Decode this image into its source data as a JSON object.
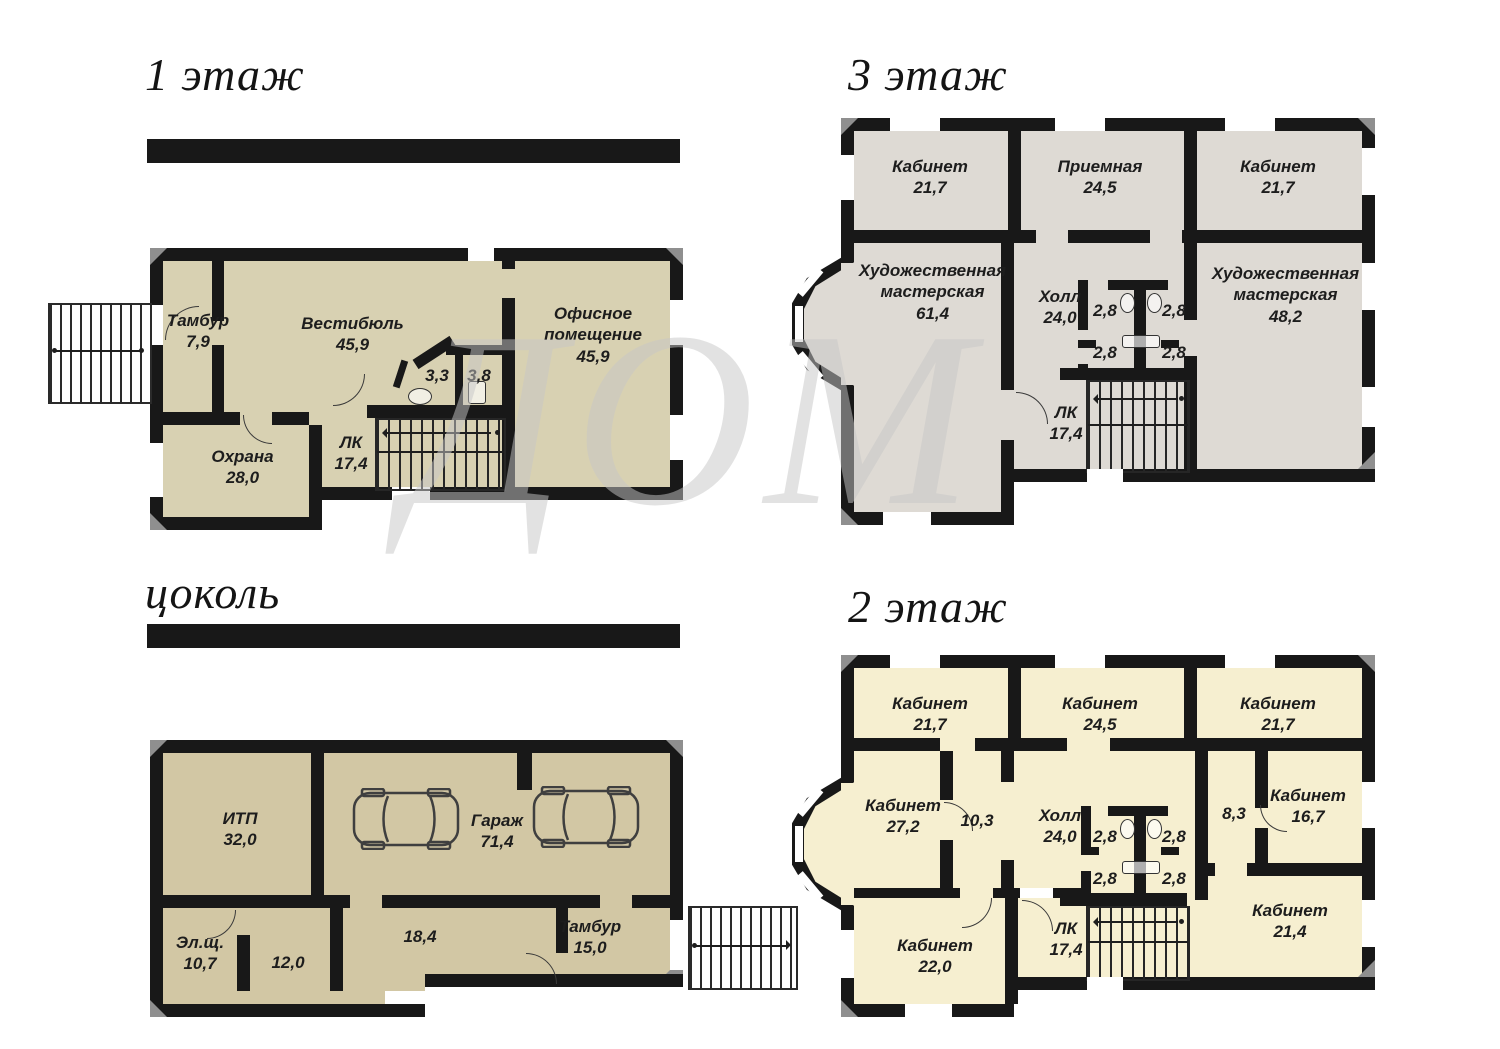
{
  "watermark": {
    "text": "ДОМ"
  },
  "colors": {
    "wall": "#181818",
    "floor1_fill": "#d8d1b2",
    "floor3_fill": "#dedad4",
    "basement_fill": "#d2c7a4",
    "floor2_fill": "#f6efd0",
    "corner_bevel": "#8f8f8f"
  },
  "floors": {
    "floor1": {
      "title": "1 этаж",
      "rooms": [
        {
          "label": "Тамбур",
          "area": "7,9"
        },
        {
          "label": "Вестибюль",
          "area": "45,9"
        },
        {
          "label": "",
          "area": "3,3"
        },
        {
          "label": "",
          "area": "3,8"
        },
        {
          "label": "Офисное помещение",
          "area": "45,9"
        },
        {
          "label": "Охрана",
          "area": "28,0"
        },
        {
          "label": "ЛК",
          "area": "17,4"
        }
      ]
    },
    "floor3": {
      "title": "3 этаж",
      "rooms": [
        {
          "label": "Кабинет",
          "area": "21,7"
        },
        {
          "label": "Приемная",
          "area": "24,5"
        },
        {
          "label": "Кабинет",
          "area": "21,7"
        },
        {
          "label": "Художественная мастерская",
          "area": "61,4"
        },
        {
          "label": "Холл",
          "area": "24,0"
        },
        {
          "label": "",
          "area": "2,8"
        },
        {
          "label": "",
          "area": "2,8"
        },
        {
          "label": "",
          "area": "2,8"
        },
        {
          "label": "",
          "area": "2,8"
        },
        {
          "label": "Художественная мастерская",
          "area": "48,2"
        },
        {
          "label": "ЛК",
          "area": "17,4"
        }
      ]
    },
    "basement": {
      "title": "цоколь",
      "rooms": [
        {
          "label": "ИТП",
          "area": "32,0"
        },
        {
          "label": "Гараж",
          "area": "71,4"
        },
        {
          "label": "Эл.щ.",
          "area": "10,7"
        },
        {
          "label": "",
          "area": "12,0"
        },
        {
          "label": "",
          "area": "18,4"
        },
        {
          "label": "Тамбур",
          "area": "15,0"
        }
      ]
    },
    "floor2": {
      "title": "2 этаж",
      "rooms": [
        {
          "label": "Кабинет",
          "area": "21,7"
        },
        {
          "label": "Кабинет",
          "area": "24,5"
        },
        {
          "label": "Кабинет",
          "area": "21,7"
        },
        {
          "label": "Кабинет",
          "area": "27,2"
        },
        {
          "label": "",
          "area": "10,3"
        },
        {
          "label": "Холл",
          "area": "24,0"
        },
        {
          "label": "",
          "area": "2,8"
        },
        {
          "label": "",
          "area": "2,8"
        },
        {
          "label": "",
          "area": "2,8"
        },
        {
          "label": "",
          "area": "2,8"
        },
        {
          "label": "",
          "area": "8,3"
        },
        {
          "label": "Кабинет",
          "area": "16,7"
        },
        {
          "label": "Кабинет",
          "area": "21,4"
        },
        {
          "label": "Кабинет",
          "area": "22,0"
        },
        {
          "label": "ЛК",
          "area": "17,4"
        }
      ]
    }
  }
}
